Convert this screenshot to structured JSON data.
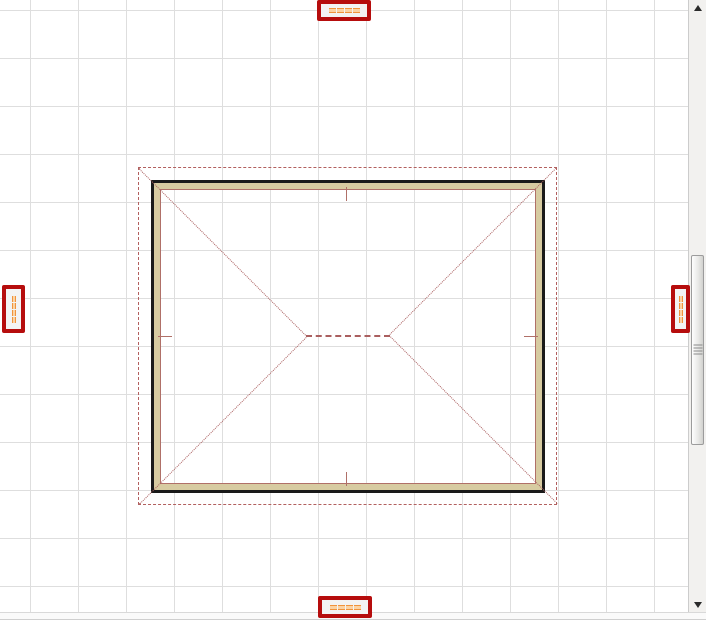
{
  "app": {
    "type": "floor-plan-editor-canvas",
    "description": "2D plan view of a rectangular building with hip roof overlay, grid background, highlighted dimension labels and vertical scrollbar"
  },
  "colors": {
    "grid": "#dedede",
    "wall_black": "#1a1a1a",
    "wall_tan": "#d7cba1",
    "wall_inner": "#b07068",
    "roof_line": "#b2605f",
    "roof_dotted": "#aa5f5f",
    "marker_red": "#b60d0d",
    "label_bg": "#f3f3f3",
    "dash_dark": "#f0933c",
    "dash_light": "#fbd3a4",
    "scroll_track": "#f2f1ef",
    "scroll_border": "#cccccc",
    "thumb_border": "#9c9c9c"
  },
  "plan": {
    "wall_outline": "black double-line exterior wall with tan fill",
    "roof_overhang": "dashed red rectangle outside walls",
    "hip_lines": "dotted diagonals from each corner meeting a dashed ridge line at center",
    "center_ticks": 4
  },
  "markers": [
    {
      "name": "dimension-label-top",
      "orientation": "horizontal",
      "dashes": 4,
      "text_state": "redacted-orange-dashes"
    },
    {
      "name": "dimension-label-bottom",
      "orientation": "horizontal",
      "dashes": 4,
      "text_state": "redacted-orange-dashes"
    },
    {
      "name": "dimension-label-left",
      "orientation": "vertical",
      "dashes": 4,
      "text_state": "redacted-orange-dashes"
    },
    {
      "name": "dimension-label-right",
      "orientation": "vertical",
      "dashes": 4,
      "text_state": "redacted-orange-dashes"
    }
  ],
  "scrollbar": {
    "orientation": "vertical",
    "thumb_position": "middle",
    "has_up_arrow": true,
    "has_down_arrow": true,
    "has_grip_lines": true
  }
}
